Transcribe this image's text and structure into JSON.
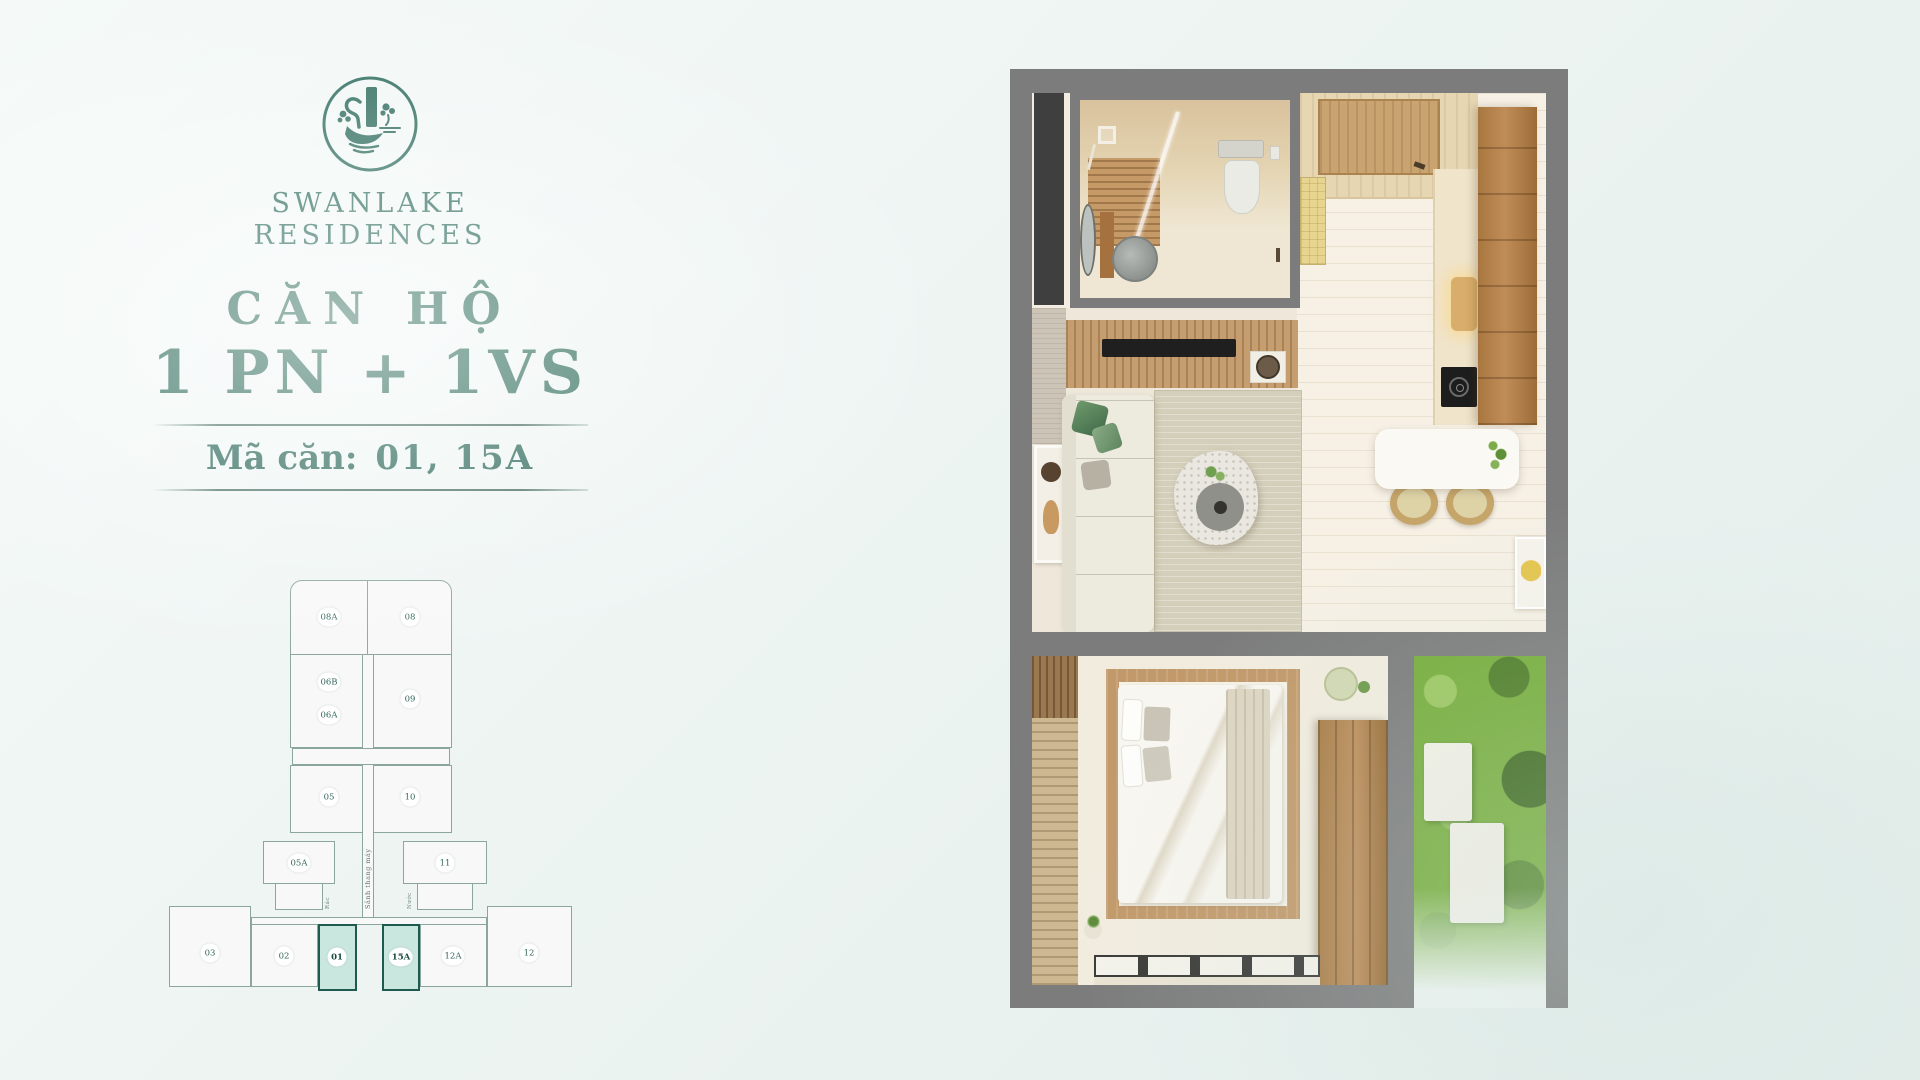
{
  "brand": {
    "logo": "swan-lake-tower-emblem",
    "name_line1": "SWANLAKE",
    "name_line2": "RESIDENCES",
    "color_primary": "#2e6b5d"
  },
  "title": {
    "label": "CĂN HỘ",
    "unit_type": "1 PN + 1VS",
    "code_label": "Mã căn:",
    "code_value": "01, 15A"
  },
  "keyplan": {
    "units": {
      "u08A": "08A",
      "u08": "08",
      "u06B": "06B",
      "u06A": "06A",
      "u09": "09",
      "u05": "05",
      "u10": "10",
      "u05A": "05A",
      "u11": "11",
      "u03": "03",
      "u02": "02",
      "u01": "01",
      "u15A": "15A",
      "u12A": "12A",
      "u12": "12"
    },
    "highlighted_units": [
      "01",
      "15A"
    ],
    "corridor_label": "Sảnh thang máy",
    "left_utility_label": "Rác",
    "right_utility_label": "Nước",
    "highlight_fill": "#c9e6df",
    "highlight_border": "#1e5b4e"
  },
  "floorplan": {
    "wall_color": "#7c7c7c",
    "rooms": [
      "bathroom",
      "entry",
      "kitchen",
      "dining",
      "living-room",
      "bedroom",
      "garden"
    ]
  }
}
